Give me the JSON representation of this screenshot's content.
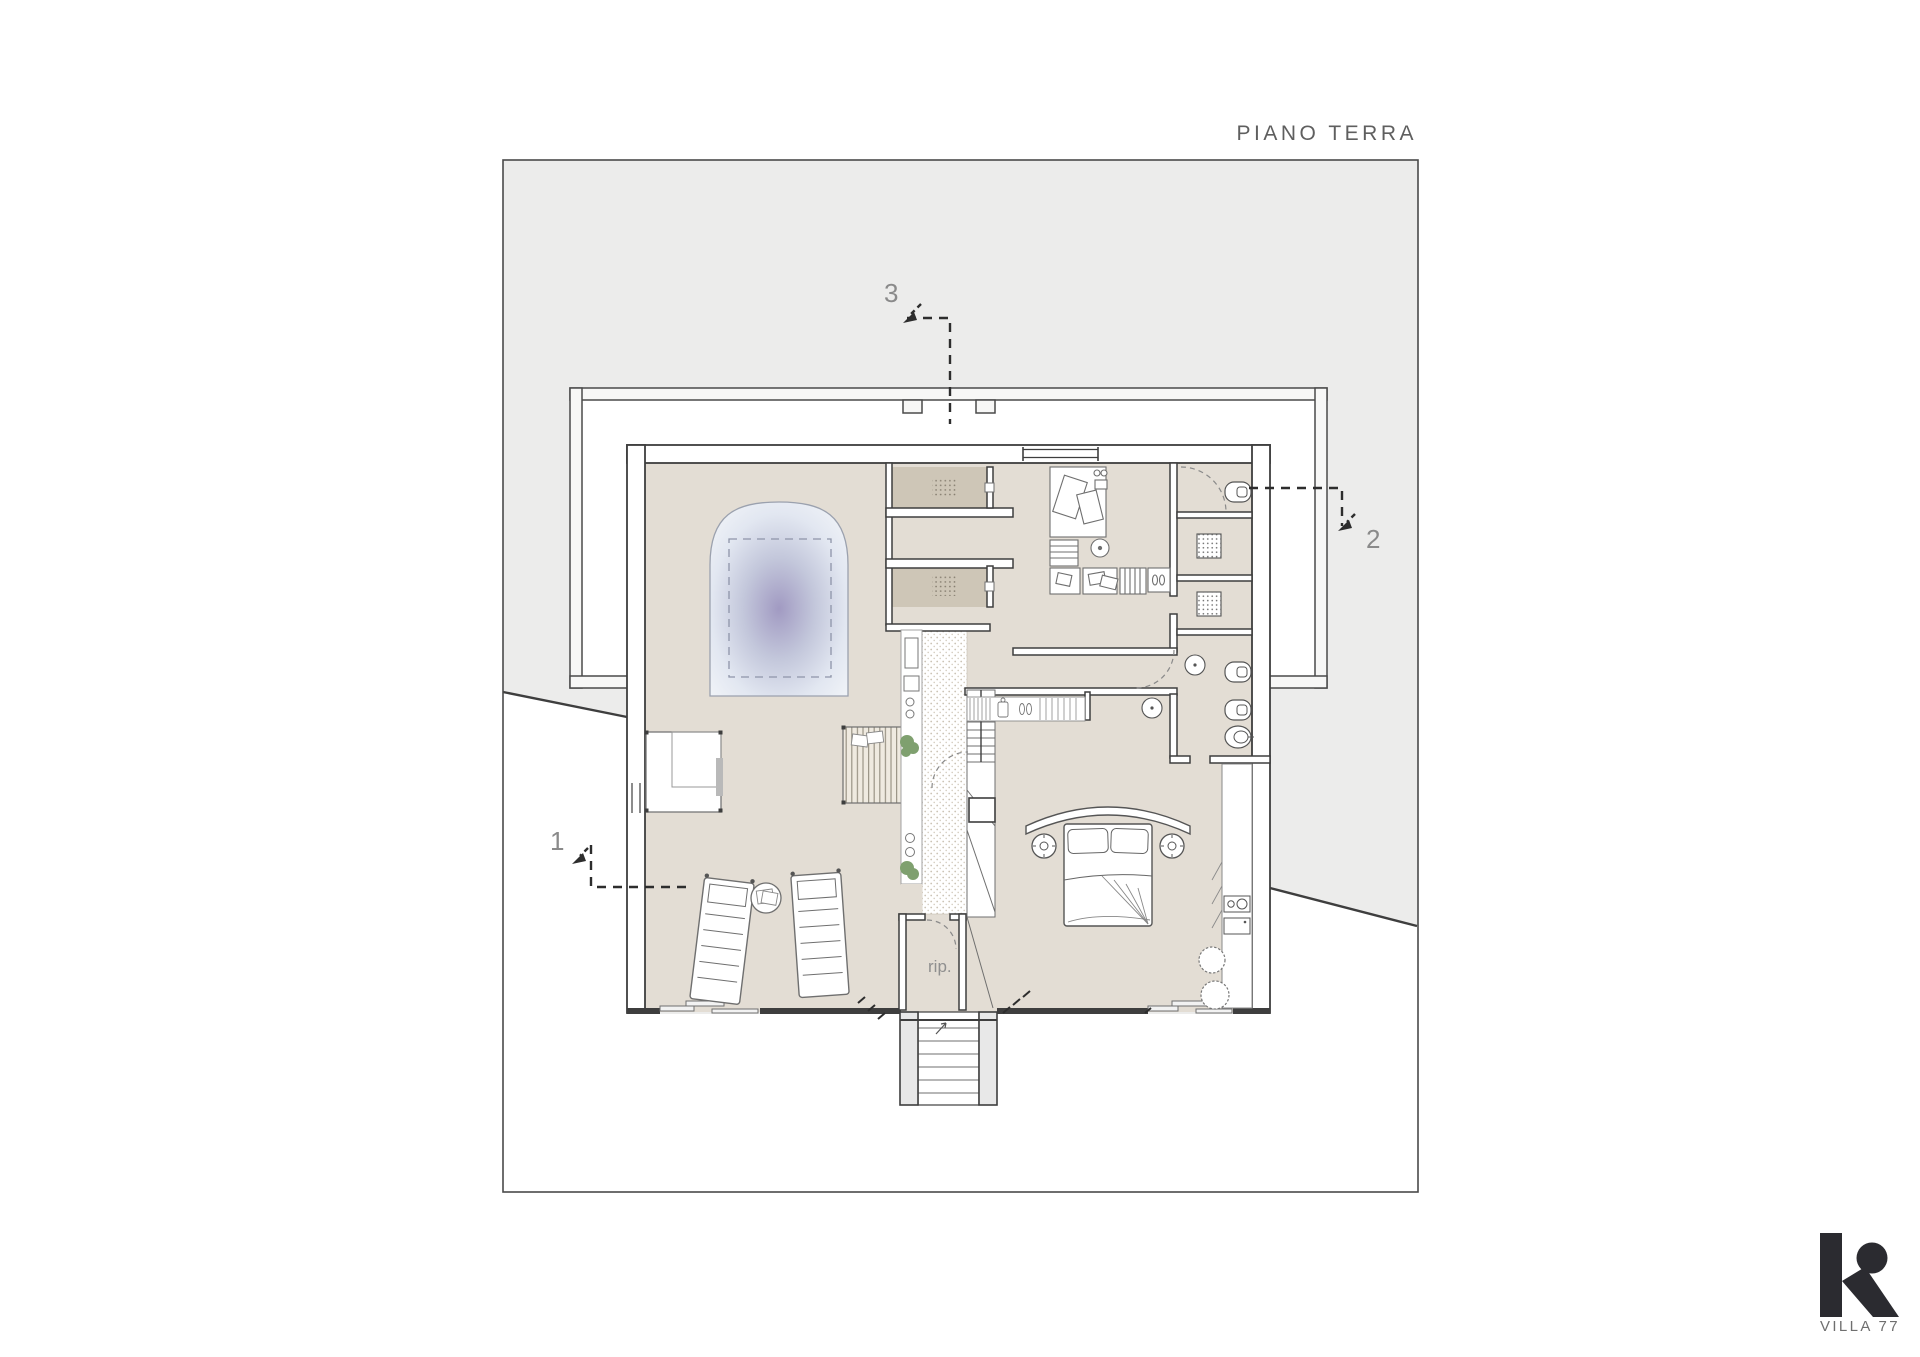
{
  "title": "PIANO TERRA",
  "logo": {
    "name": "VILLA 77"
  },
  "plan": {
    "storage_label": "rip.",
    "markers": {
      "m1": "1",
      "m2": "2",
      "m3": "3"
    }
  },
  "colors": {
    "terrain": "#ECECEB",
    "floor": "#E3DDD4",
    "closet_floor": "#CEC6B7",
    "wall": "#3E3E3E",
    "garden_wall_fill": "#F7F7F6",
    "pool_center": "#A19AC2",
    "plant": "#7FA06F",
    "label": "#8A8A8A",
    "logo_ink": "#2B2B30"
  }
}
